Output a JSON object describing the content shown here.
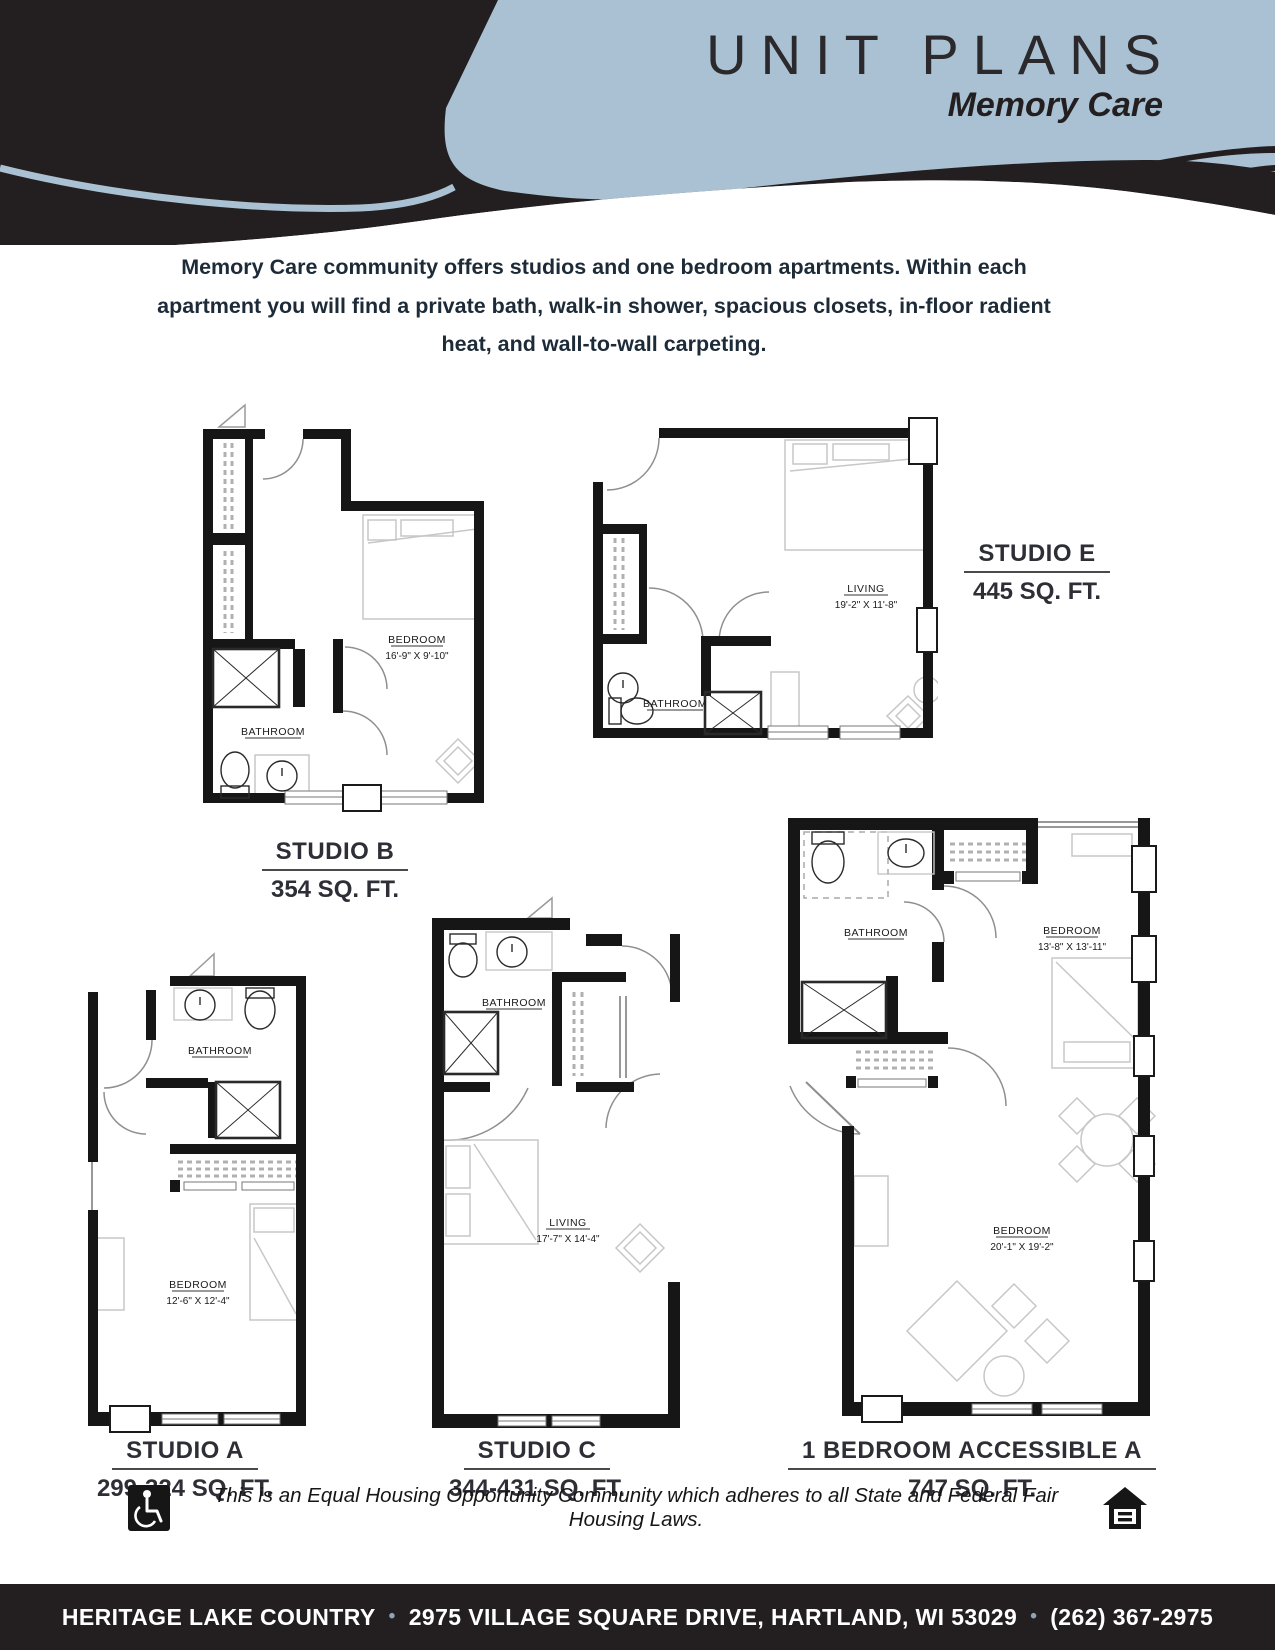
{
  "header": {
    "title": "UNIT PLANS",
    "subtitle": "Memory Care"
  },
  "intro": {
    "text": "Memory Care community offers studios and one bedroom apartments. Within each apartment you will find a private bath, walk-in shower, spacious closets, in-floor radient heat, and wall-to-wall carpeting."
  },
  "plans": {
    "studio_b": {
      "name": "STUDIO B",
      "area": "354 SQ. FT.",
      "bedroom_label": "BEDROOM",
      "bedroom_dims": "16'-9\" X 9'-10\"",
      "bathroom_label": "BATHROOM"
    },
    "studio_e": {
      "name": "STUDIO E",
      "area": "445 SQ. FT.",
      "living_label": "LIVING",
      "living_dims": "19'-2\" X 11'-8\"",
      "bathroom_label": "BATHROOM"
    },
    "studio_a": {
      "name": "STUDIO A",
      "area": "299-324 SQ. FT.",
      "bedroom_label": "BEDROOM",
      "bedroom_dims": "12'-6\" X 12'-4\"",
      "bathroom_label": "BATHROOM"
    },
    "studio_c": {
      "name": "STUDIO C",
      "area": "344-431 SQ. FT.",
      "living_label": "LIVING",
      "living_dims": "17'-7\" X 14'-4\"",
      "bathroom_label": "BATHROOM"
    },
    "one_br_a": {
      "name": "1 BEDROOM ACCESSIBLE A",
      "area": "747 SQ. FT.",
      "bathroom_label": "BATHROOM",
      "bedroom1_label": "BEDROOM",
      "bedroom1_dims": "13'-8\" X 13'-11\"",
      "bedroom2_label": "BEDROOM",
      "bedroom2_dims": "20'-1\" X 19'-2\""
    }
  },
  "disclaimer": {
    "text": "This is an Equal Housing Opportunity Community which adheres to all State and Federal Fair Housing Laws."
  },
  "footer": {
    "name": "HERITAGE LAKE COUNTRY",
    "address": "2975 VILLAGE SQUARE DRIVE, HARTLAND, WI 53029",
    "phone": "(262) 367-2975",
    "bullet": "•"
  },
  "colors": {
    "banner_blue": "#a9c1d2",
    "ink": "#231f20",
    "bullet_blue": "#8ba4b8"
  }
}
